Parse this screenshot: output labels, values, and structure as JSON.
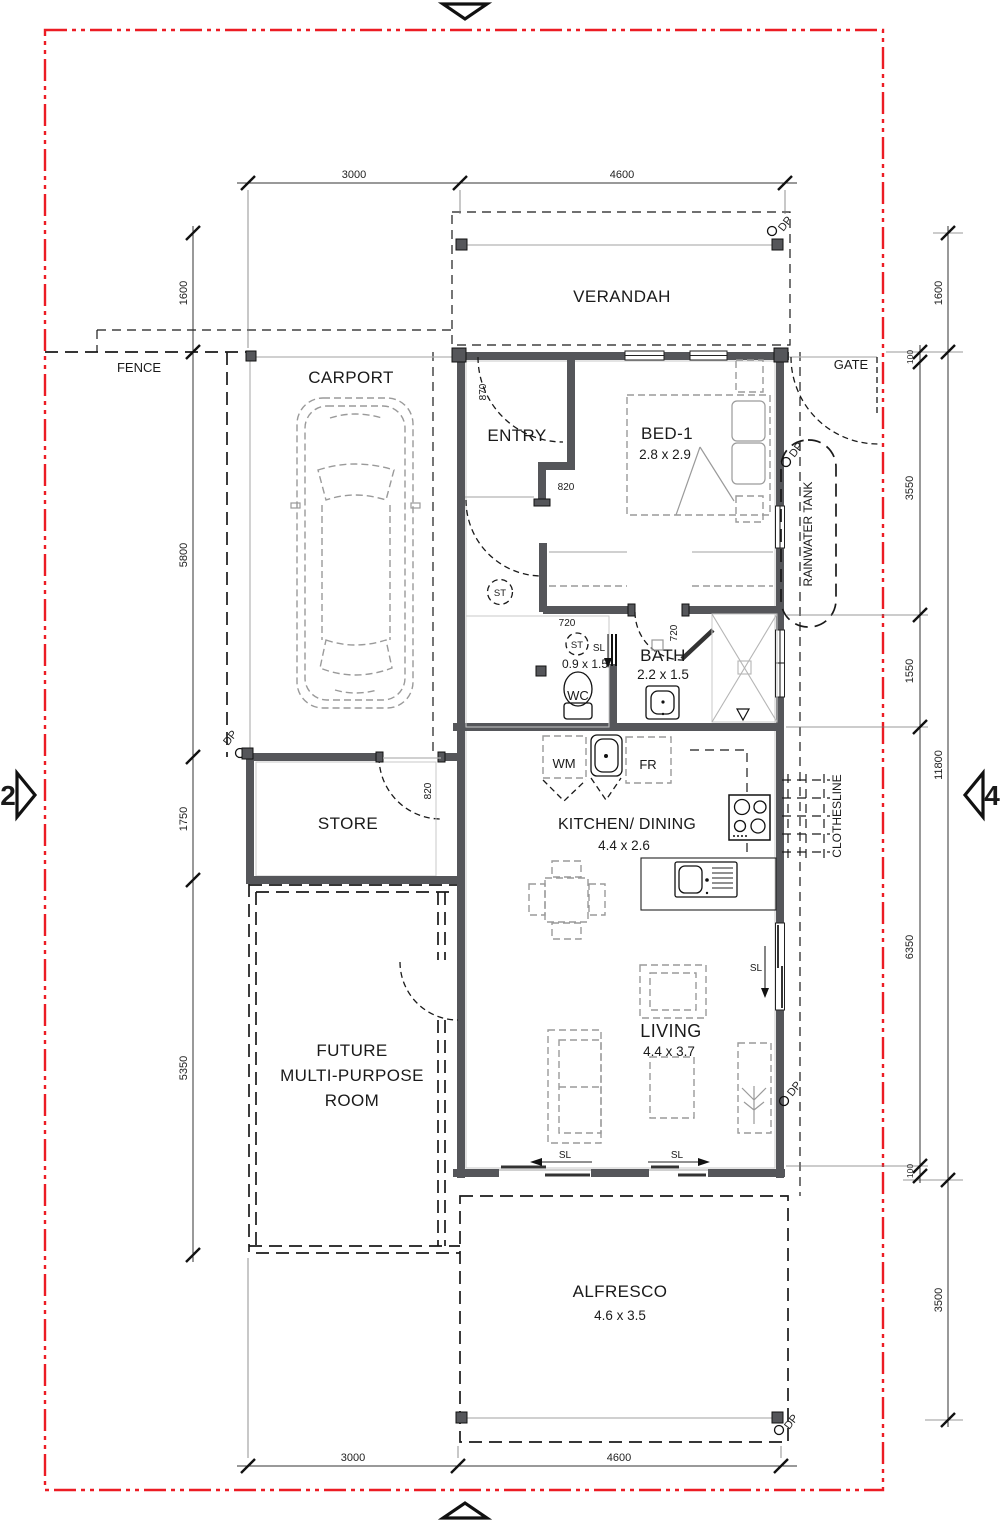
{
  "markers": {
    "left": "2",
    "right": "4"
  },
  "site": {
    "fence": "FENCE",
    "gate": "GATE"
  },
  "rooms": {
    "verandah": {
      "label": "VERANDAH"
    },
    "carport": {
      "label": "CARPORT"
    },
    "entry": {
      "label": "ENTRY"
    },
    "bed1": {
      "label": "BED-1",
      "size": "2.8 x 2.9"
    },
    "wc": {
      "label": "WC",
      "size": "0.9 x 1.5"
    },
    "bath": {
      "label": "BATH",
      "size": "2.2 x 1.5"
    },
    "store": {
      "label": "STORE"
    },
    "kitchen": {
      "label": "KITCHEN/ DINING",
      "size": "4.4 x 2.6"
    },
    "living": {
      "label": "LIVING",
      "size": "4.4 x 3.7"
    },
    "future": {
      "line1": "FUTURE",
      "line2": "MULTI-PURPOSE",
      "line3": "ROOM"
    },
    "alfresco": {
      "label": "ALFRESCO",
      "size": "4.6 x 3.5"
    },
    "tank": {
      "label": "RAINWATER TANK"
    },
    "clothesline": {
      "label": "CLOTHESLINE"
    }
  },
  "fixtures": {
    "wm": "WM",
    "fr": "FR",
    "st": "ST",
    "sl": "SL",
    "dp": "DP"
  },
  "dims": {
    "top": [
      "3000",
      "4600"
    ],
    "bottom": [
      "3000",
      "4600"
    ],
    "left": [
      "1600",
      "5800",
      "1750",
      "5350"
    ],
    "right_outer": [
      "1600",
      "11800",
      "3500"
    ],
    "right_inner": [
      "100",
      "3550",
      "1550",
      "6350",
      "100"
    ],
    "doors": {
      "entry": "870",
      "hall": "820",
      "store": "820",
      "wc": "720",
      "bath": "720"
    }
  },
  "colors": {
    "boundary": "#ec1c24",
    "wall": "#55565a",
    "furniture": "#9a9a9a"
  }
}
